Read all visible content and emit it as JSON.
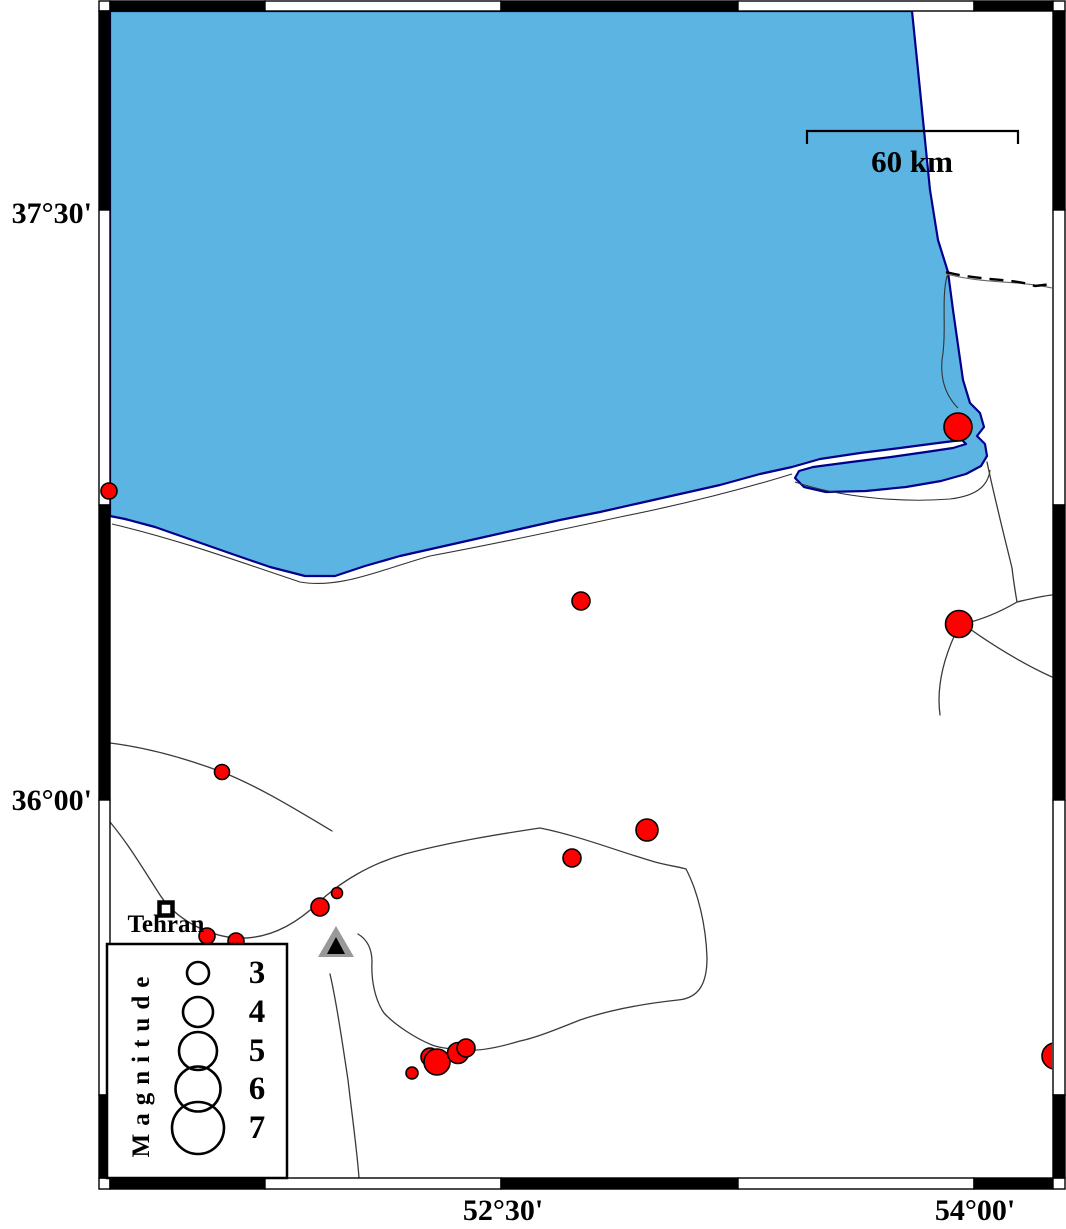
{
  "map": {
    "title": "Seismicity map of the southeastern Caspian Sea coast",
    "labels": {
      "lat_top": "37°30'",
      "lat_bottom": "36°00'",
      "lon_left": "52°30'",
      "lon_right": "54°00'"
    },
    "scale_bar": {
      "label": "60 km",
      "length_km": 60
    },
    "city": {
      "name": "Tehran"
    },
    "station": {
      "symbol": "triangle"
    },
    "colors": {
      "water": "#5BB4E2",
      "coast": "#00008B",
      "earthquake": "#FF0000",
      "outline": "#000000",
      "station_gray": "#999999"
    },
    "legend": {
      "title": "Magnitude",
      "circle_cx": 198,
      "entries": [
        {
          "label": "3",
          "magnitude": 3,
          "cy": 973,
          "r": 11
        },
        {
          "label": "4",
          "magnitude": 4,
          "cy": 1012,
          "r": 15
        },
        {
          "label": "5",
          "magnitude": 5,
          "cy": 1051,
          "r": 19
        },
        {
          "label": "6",
          "magnitude": 6,
          "cy": 1089,
          "r": 22.5
        },
        {
          "label": "7",
          "magnitude": 7,
          "cy": 1128,
          "r": 26
        }
      ]
    },
    "earthquakes": [
      {
        "x": 958,
        "y": 427,
        "r": 14,
        "magnitude_est": 3.8
      },
      {
        "x": 109,
        "y": 491,
        "r": 8,
        "magnitude_est": 2.2
      },
      {
        "x": 581,
        "y": 601,
        "r": 9,
        "magnitude_est": 2.5
      },
      {
        "x": 959,
        "y": 624,
        "r": 13.5,
        "magnitude_est": 3.7
      },
      {
        "x": 222,
        "y": 772,
        "r": 7.5,
        "magnitude_est": 2.1
      },
      {
        "x": 647,
        "y": 830,
        "r": 11,
        "magnitude_est": 3.0
      },
      {
        "x": 572,
        "y": 858,
        "r": 9,
        "magnitude_est": 2.5
      },
      {
        "x": 337,
        "y": 893,
        "r": 5.5,
        "magnitude_est": 1.5
      },
      {
        "x": 320,
        "y": 907,
        "r": 9,
        "magnitude_est": 2.5
      },
      {
        "x": 207,
        "y": 936,
        "r": 8,
        "magnitude_est": 2.2
      },
      {
        "x": 236,
        "y": 941,
        "r": 8,
        "magnitude_est": 2.2
      },
      {
        "x": 412,
        "y": 1073,
        "r": 6,
        "magnitude_est": 1.7
      },
      {
        "x": 430,
        "y": 1057,
        "r": 9,
        "magnitude_est": 2.5
      },
      {
        "x": 437,
        "y": 1062,
        "r": 13,
        "magnitude_est": 3.5
      },
      {
        "x": 458,
        "y": 1053,
        "r": 10.5,
        "magnitude_est": 2.9
      },
      {
        "x": 466,
        "y": 1048,
        "r": 9,
        "magnitude_est": 2.5
      },
      {
        "x": 1055,
        "y": 1056,
        "r": 13,
        "magnitude_est": 3.5,
        "clipped": true
      }
    ]
  }
}
